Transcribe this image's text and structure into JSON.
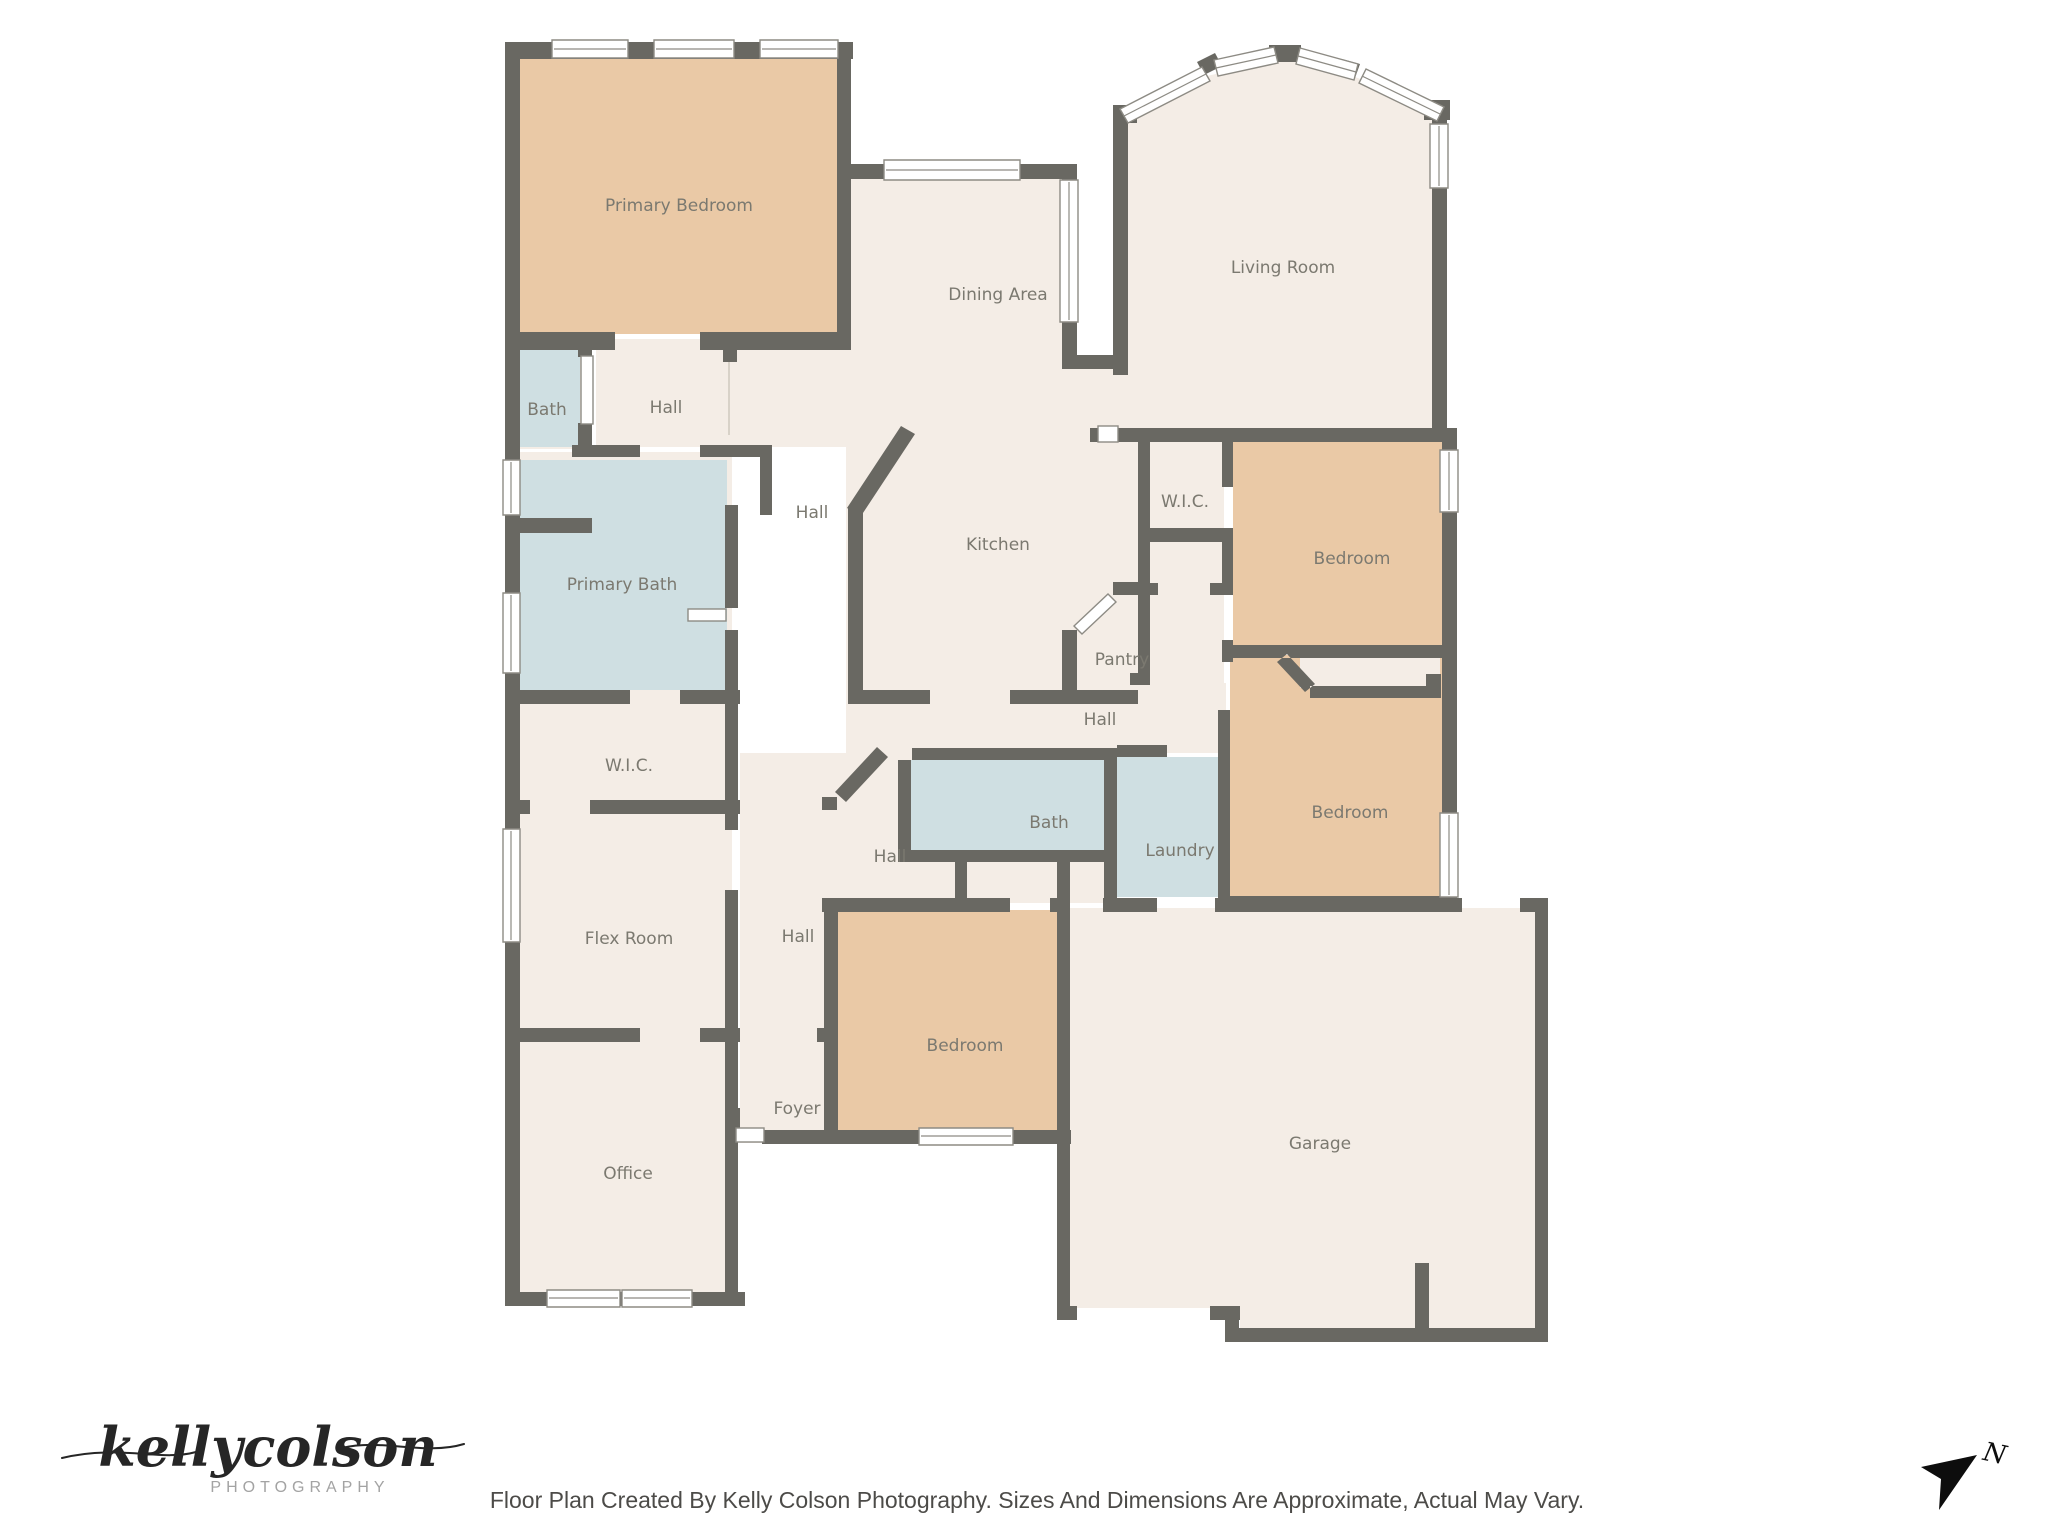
{
  "rooms": {
    "primary_bedroom": "Primary Bedroom",
    "dining_area": "Dining Area",
    "living_room": "Living Room",
    "bath_primary_small": "Bath",
    "hall_a": "Hall",
    "hall_b": "Hall",
    "primary_bath": "Primary Bath",
    "kitchen": "Kitchen",
    "wic_bedroom1": "W.I.C.",
    "bedroom_1": "Bedroom",
    "pantry": "Pantry",
    "hall_c": "Hall",
    "wic_primary": "W.I.C.",
    "hall_d": "Hall",
    "bath_hall": "Bath",
    "laundry": "Laundry",
    "bedroom_2": "Bedroom",
    "flex_room": "Flex Room",
    "hall_e": "Hall",
    "bedroom_3": "Bedroom",
    "foyer": "Foyer",
    "office": "Office",
    "garage": "Garage"
  },
  "footer": {
    "disclaimer": "Floor Plan Created By Kelly Colson Photography. Sizes And Dimensions Are Approximate, Actual May Vary.",
    "logo_script": "kellycolson",
    "logo_word": "PHOTOGRAPHY"
  },
  "compass": {
    "direction": "N"
  },
  "palette": {
    "wall": "#696862",
    "room": "#f4ede6",
    "bedroom": "#eac9a6",
    "wet": "#cfdfe2",
    "text": "#7b7970"
  }
}
